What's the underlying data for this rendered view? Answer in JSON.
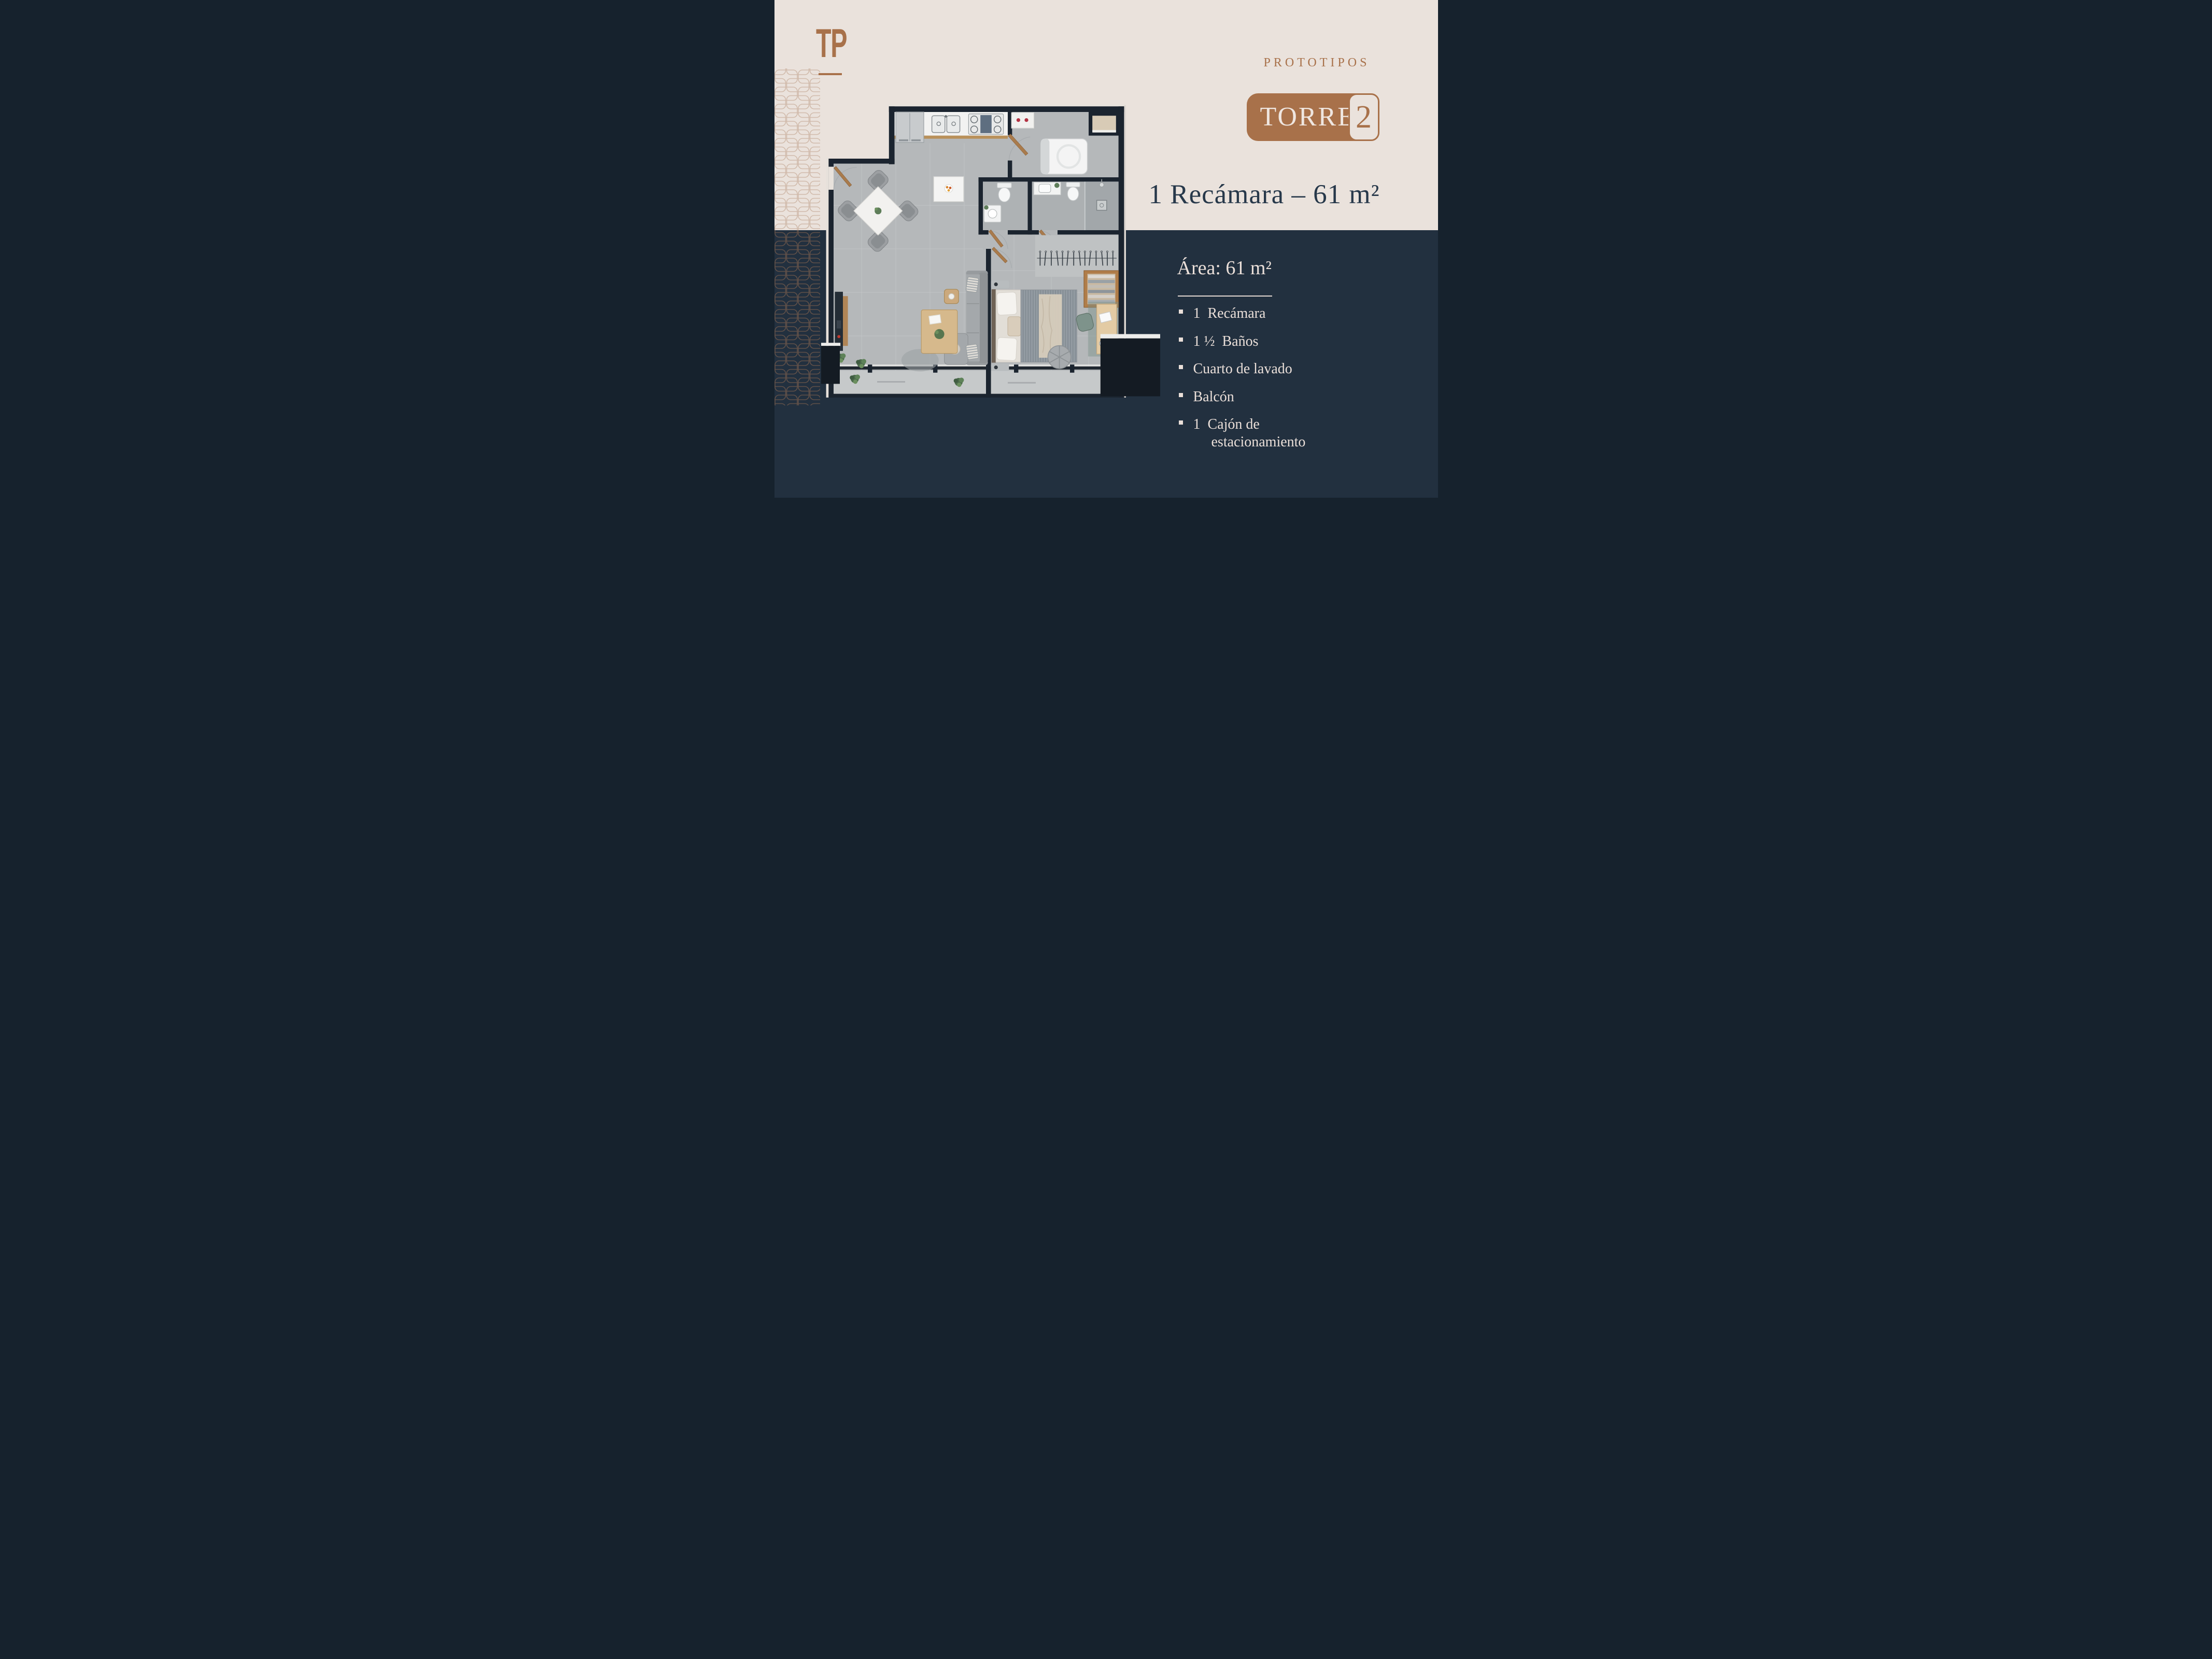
{
  "brand": {
    "logo": "TP"
  },
  "header": {
    "eyebrow": "PROTOTIPOS",
    "badge": {
      "tower_label": "TORRE",
      "tower_number": "2"
    }
  },
  "headline": {
    "text": "1 Recámara – 61 m²"
  },
  "details": {
    "area_title": "Área: 61 m²",
    "features": [
      "1  Recámara",
      "1 ½  Baños",
      "Cuarto de lavado",
      "Balcón",
      "1  Cajón de\n     estacionamiento"
    ]
  },
  "colors": {
    "cream_background": "#EAE2DC",
    "navy_background": "#22303F",
    "brand_brown": "#A8714A",
    "heading_navy": "#27384A",
    "text_cream": "#EADFD9",
    "plan_walls": "#1B242F",
    "plan_floor": "#B5B8BA"
  }
}
